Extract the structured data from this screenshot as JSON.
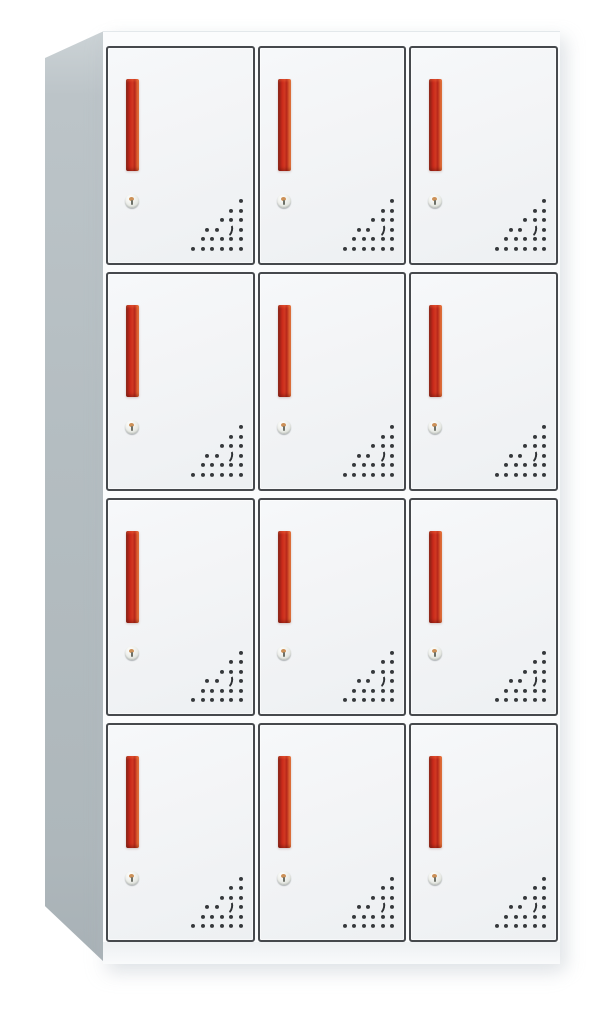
{
  "image": {
    "type": "product-photo",
    "subject": "12-door steel locker cabinet",
    "view": "front three-quarter, left side panel visible",
    "background": "plain white"
  },
  "cabinet": {
    "rows": 4,
    "columns": 3,
    "door_count": 12,
    "door_features": {
      "handle": "vertical-red-recessed-handle",
      "lock": "round-cam-keyhole-lock",
      "vents": "triangular-perforation-grid-bottom-right"
    },
    "vents": {
      "rows_dot_counts": [
        1,
        2,
        3,
        4,
        5,
        6
      ],
      "crescent_row_index": 3,
      "crescent_dot_index": 2
    },
    "colors": {
      "background": "#ffffff",
      "side_panel": "#b4bdc1",
      "side_panel_light": "#ccd3d6",
      "front_frame": "#fbfcfd",
      "door_face": "#f3f4f6",
      "door_face_deep": "#edf0f2",
      "door_border": "#46494d",
      "handle_dark": "#832218",
      "handle_red": "#c9291a",
      "handle_highlight": "#ec7038",
      "vent_dot": "#35383b",
      "lock_body": "#e9ebe6",
      "base_strip": "#eef1f3"
    }
  }
}
